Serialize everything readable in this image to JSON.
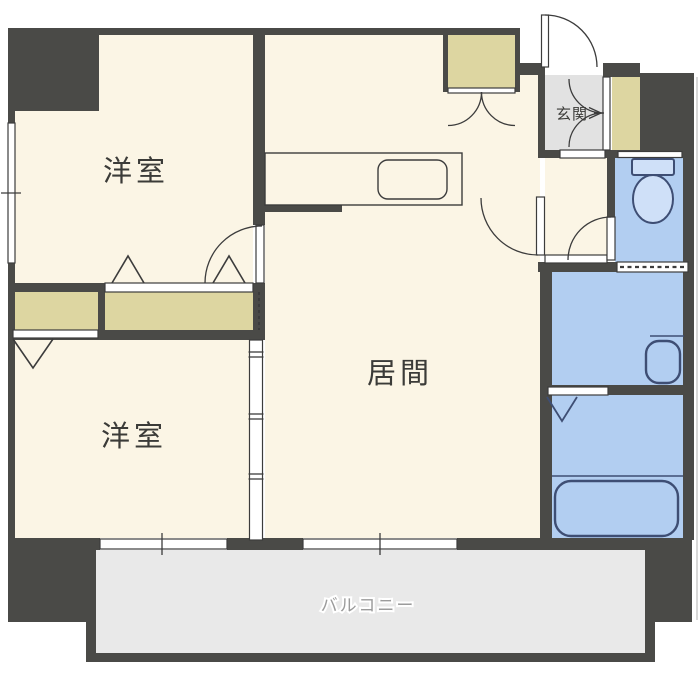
{
  "type": "floor_plan",
  "labels": {
    "room_top_left": "洋室",
    "room_bottom_left": "洋室",
    "living_room": "居間",
    "entrance": "玄関",
    "balcony": "バルコニー"
  },
  "icons": [
    "toilet-icon",
    "washbasin-icon",
    "bathtub-icon",
    "kitchen-sink-icon",
    "entrance-arrow-icon",
    "door-swing-arc",
    "folding-door-triangle"
  ],
  "colors": {
    "wall": "#4a4a47",
    "floor": "#fbf5e5",
    "closet": "#ddd6a1",
    "entrance_floor": "#e2e2e2",
    "balcony_floor": "#e9e9e9",
    "water_area": "#b2cef1",
    "fixture_fill": "#cfe0f8",
    "fixture_stroke": "#3e4e74",
    "line": "#3c3c3c",
    "label_text": "#3b3b38",
    "balcony_text": "#9b9b9b",
    "outer_hairline": "#c8c8c8"
  }
}
